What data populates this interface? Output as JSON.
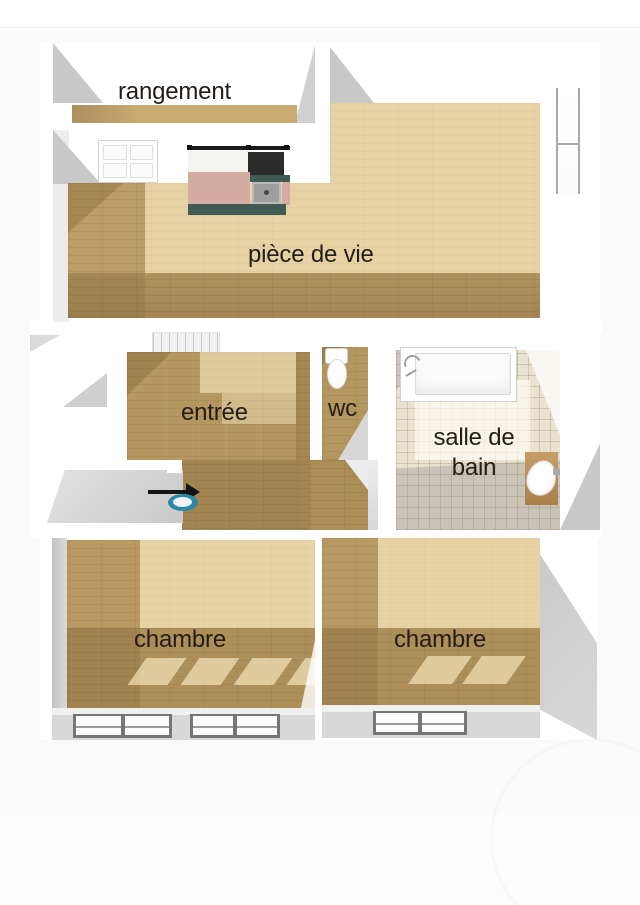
{
  "page": {
    "background": "#ffffff",
    "divider_color": "#eaeaea",
    "canvas_background": "#fafafa"
  },
  "floorplan": {
    "rooms": [
      {
        "id": "rangement",
        "label": "rangement"
      },
      {
        "id": "piece_de_vie",
        "label": "pièce de vie"
      },
      {
        "id": "entree",
        "label": "entrée"
      },
      {
        "id": "wc",
        "label": "wc"
      },
      {
        "id": "salle_de_bain",
        "label": "salle de bain"
      },
      {
        "id": "chambre_gauche",
        "label": "chambre"
      },
      {
        "id": "chambre_droite",
        "label": "chambre"
      }
    ],
    "fixtures": {
      "entrance_arrow": "arrow-right-icon",
      "entry_basin": "washbasin-icon",
      "kitchen_counter": "kitchen-counter-icon",
      "stove": "stove-icon",
      "kitchen_sink": "kitchen-sink-icon",
      "double_door": "double-door-icon",
      "staircase": "staircase-icon",
      "toilet": "toilet-icon",
      "bathtub": "bathtub-icon",
      "bathroom_washbasin": "washbasin-icon",
      "living_room_window": "window-icon",
      "bedroom_left_windows": "window-icon",
      "bedroom_right_window": "window-icon",
      "watermark": "watermark-circle"
    },
    "colors": {
      "wood_base": "#c9aa70",
      "wood_entree": "#b5975f",
      "tile_floor": "#eae2d1",
      "counter_pink": "#d5aca2",
      "cabinet_teal": "#3f5b53",
      "stove_black": "#2b2b2b",
      "entry_blue": "#2c8aa6",
      "arrow_black": "#151515",
      "bottom_wall_gray": "#d8d8d8",
      "wall_shadow_gray": "#c8c8c8",
      "label_text": "#241d17"
    }
  }
}
